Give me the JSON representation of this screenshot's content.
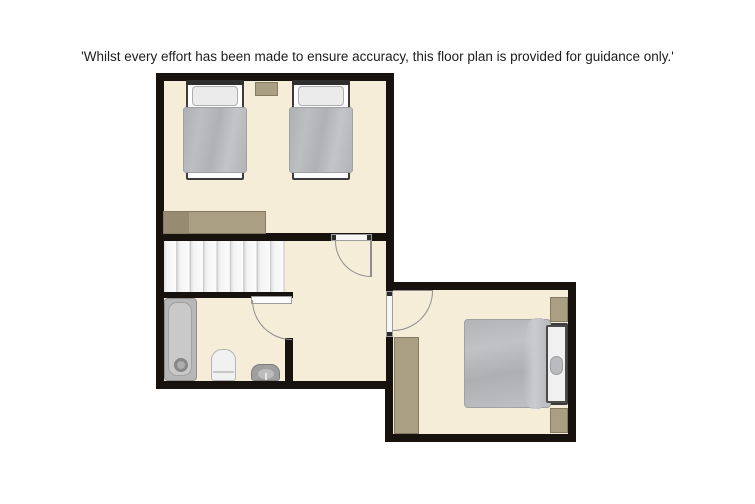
{
  "disclaimer": {
    "text": "'Whilst every effort has been made to ensure accuracy, this floor plan is provided for guidance only.'"
  },
  "palette": {
    "background": "#ffffff",
    "wall": "#17120d",
    "floor": "#f5edd8",
    "furniture_tan": "#aa9e83",
    "furniture_tan_dark": "#978b71",
    "bedding_gray": "#b4b6ba",
    "pillow_white": "#ebebeb",
    "stairs_white": "#f6f6f6",
    "fixture_gray": "#b3b3b3",
    "door_arc": "#8d8d8d",
    "text": "#1d1d1d"
  },
  "floorplan": {
    "rooms": [
      {
        "area": "twin-bedroom",
        "furniture": [
          "single-bed",
          "single-bed",
          "nightstand",
          "dresser"
        ]
      },
      {
        "area": "landing-hallway",
        "furniture": [
          "staircase"
        ]
      },
      {
        "area": "bathroom",
        "furniture": [
          "bathtub",
          "washbasin",
          "toilet"
        ]
      },
      {
        "area": "double-bedroom",
        "furniture": [
          "double-bed",
          "wardrobe",
          "nightstand",
          "nightstand"
        ]
      }
    ],
    "door_symbols": 3,
    "staircase_steps": 9
  }
}
